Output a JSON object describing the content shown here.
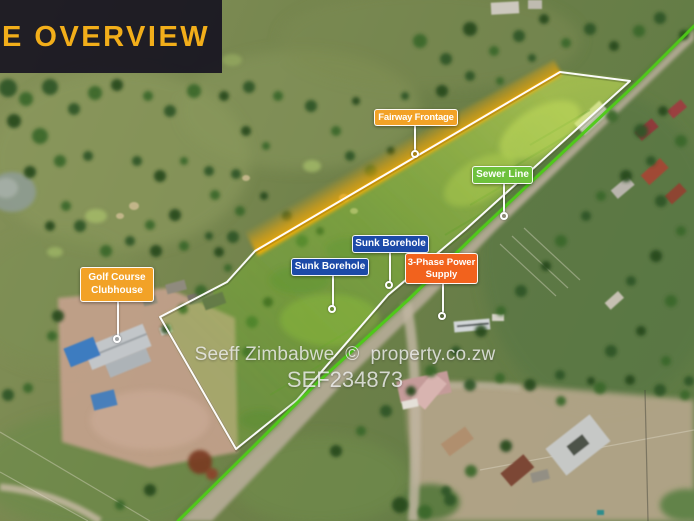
{
  "banner": {
    "title": "E OVERVIEW",
    "title_color": "#F2AE1A",
    "bg_color": "#0E091C"
  },
  "watermark": {
    "line1": "Seeff Zimbabwe  ©  property.co.zw",
    "line2": "SEF234873"
  },
  "annotations": {
    "labels": [
      {
        "id": "fairway-frontage",
        "text": "Fairway Frontage",
        "color": "#F2A227"
      },
      {
        "id": "sewer-line",
        "text": "Sewer Line",
        "color": "#6EC13C"
      },
      {
        "id": "sunk-borehole-upper",
        "text": "Sunk Borehole",
        "color": "#1C4AA8"
      },
      {
        "id": "sunk-borehole-lower",
        "text": "Sunk Borehole",
        "color": "#1C4AA8"
      },
      {
        "id": "three-phase-power",
        "text": "3-Phase Power Supply",
        "color": "#F2621D"
      },
      {
        "id": "golf-course-clubhouse",
        "text": "Golf Course Clubhouse",
        "color": "#F2A227"
      }
    ],
    "boundary_color": "#FFFFFF",
    "sewer_line_color": "#4ECB17",
    "frontage_band_color": "#FFB400",
    "parcel_tint": "#8FD232"
  }
}
